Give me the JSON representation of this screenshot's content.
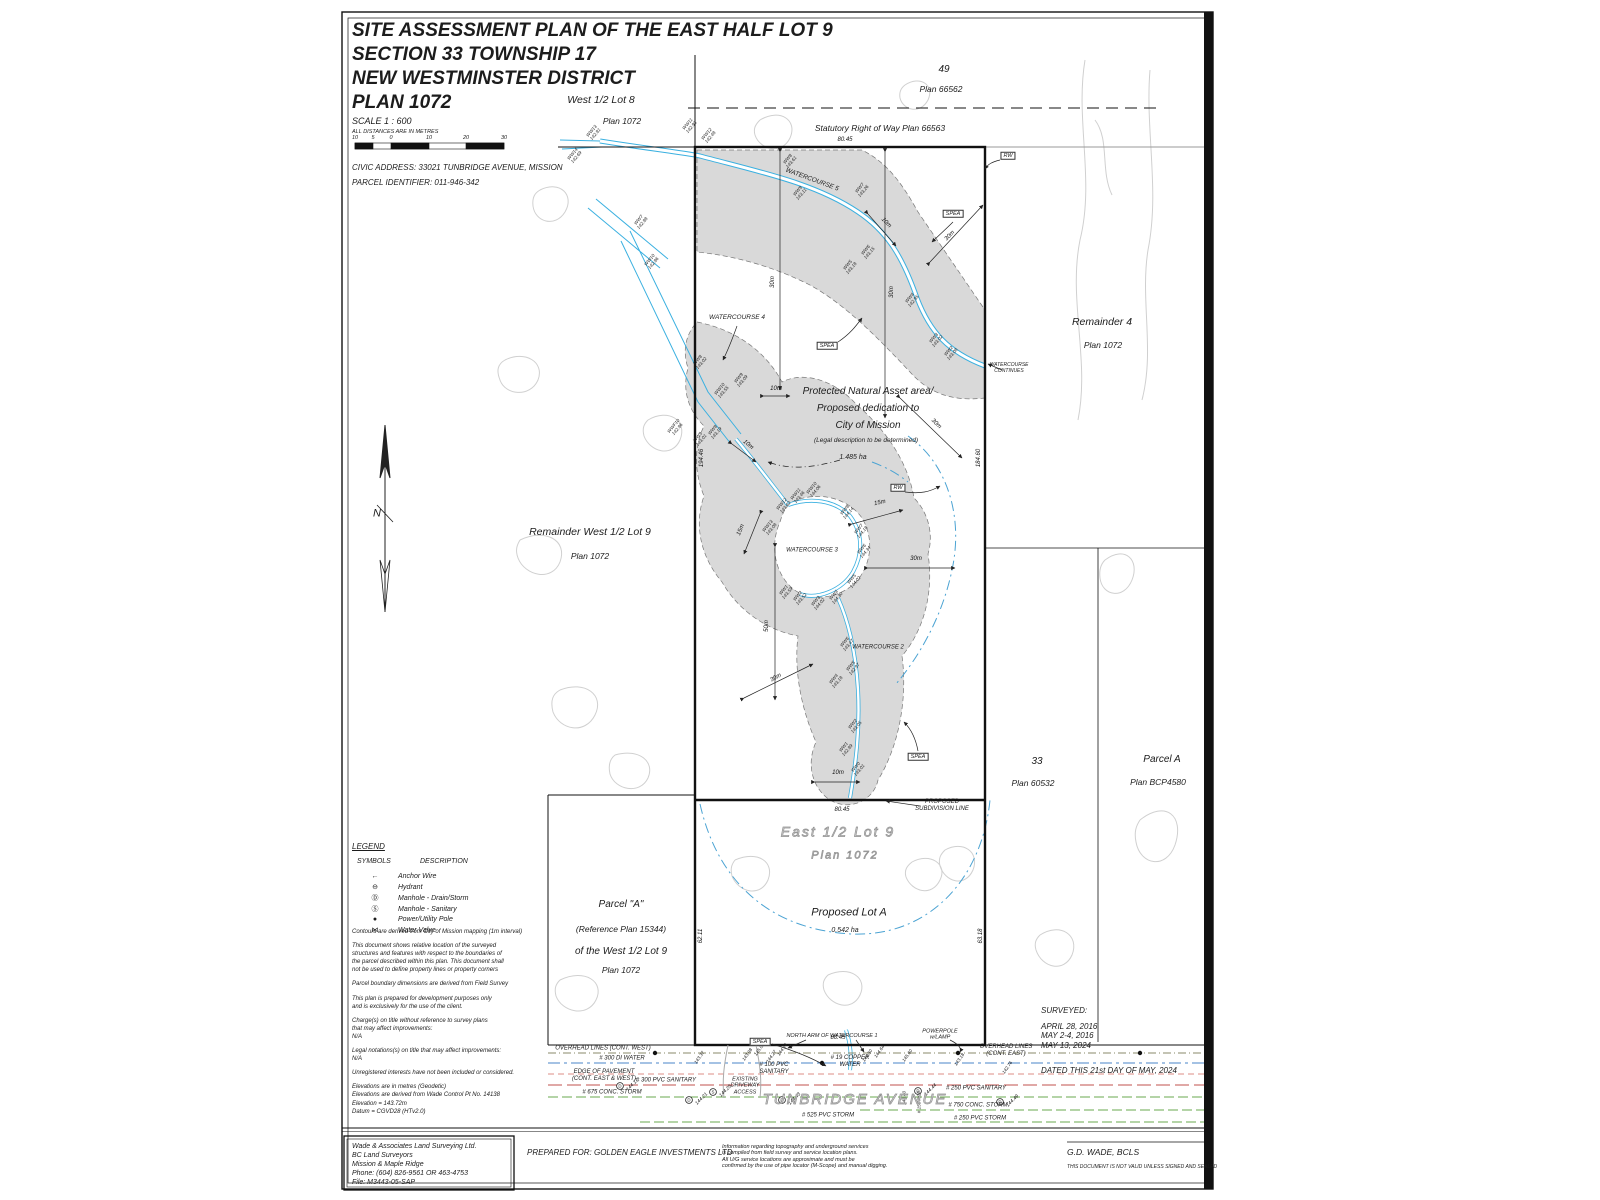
{
  "title_block": {
    "line1": "SITE ASSESSMENT PLAN OF THE EAST HALF LOT 9",
    "line2": "SECTION 33 TOWNSHIP 17",
    "line3": "NEW WESTMINSTER DISTRICT",
    "line4": "PLAN 1072",
    "scale_label": "SCALE    1 : 600",
    "distance_note": "ALL DISTANCES ARE IN METRES",
    "scale_ticks": [
      "10",
      "5",
      "0",
      "10",
      "20",
      "30"
    ],
    "civic_address": "CIVIC ADDRESS: 33021 TUNBRIDGE AVENUE, MISSION",
    "parcel_id": "PARCEL IDENTIFIER: 011-946-342"
  },
  "legend": {
    "heading": "LEGEND",
    "symbols_header": "SYMBOLS",
    "description_header": "DESCRIPTION",
    "items": [
      {
        "sym": "←",
        "label": "Anchor Wire"
      },
      {
        "sym": "⊖",
        "label": "Hydrant"
      },
      {
        "sym": "Ⓓ",
        "label": "Manhole - Drain/Storm"
      },
      {
        "sym": "Ⓢ",
        "label": "Manhole - Sanitary"
      },
      {
        "sym": "●",
        "label": "Power/Utility Pole"
      },
      {
        "sym": "⋈",
        "label": "Water Valve"
      }
    ]
  },
  "notes": [
    "Contours are derived from City of Mission mapping (1m interval)",
    "This document shows relative location of the surveyed\nstructures and features with respect to the boundaries of\nthe parcel described within this plan. This document shall\nnot be used to define property lines or property corners",
    "Parcel boundary dimensions are derived from Field Survey",
    "This plan is prepared for development purposes only\nand is exclusively for the use of the client.",
    "Charge(s) on title without reference to survey plans\nthat may affect improvements:\nN/A",
    "Legal notations(s) on title that may affect improvements:\nN/A",
    "Unregistered interests have not been included or considered.",
    "Elevations are in metres (Geodetic)\nElevations are derived from Wade Control Pt No. 14138\nElevation = 143.72m\nDatum = CGVD28 (HTv2.0)"
  ],
  "firm_box": {
    "lines": [
      "Wade & Associates Land Surveying Ltd.",
      "BC Land Surveyors",
      "Mission & Maple Ridge",
      "Phone: (604) 826-9561 OR 463-4753",
      "File: M3443-05-SAP"
    ]
  },
  "footer": {
    "prepared_for": "PREPARED FOR: GOLDEN EAGLE INVESTMENTS LTD",
    "info_note": "Information regarding topography and underground services\nis compiled from field survey and service location plans.\nAll U/G service locations are approximate and must be\nconfirmed by the use of pipe locator (M-Scope) and manual digging.",
    "surveyed_heading": "SURVEYED:",
    "survey_dates": [
      "APRIL 28, 2016",
      "MAY 2-4, 2016",
      "MAY 13, 2024"
    ],
    "dated_line": "DATED THIS 21st DAY OF MAY, 2024",
    "surveyor": "G.D. WADE, BCLS",
    "validity_note": "THIS DOCUMENT IS NOT VALID UNLESS SIGNED AND SEALED"
  },
  "plan": {
    "parcels": {
      "west_lot8": {
        "name": "West 1/2 Lot 8",
        "plan": "Plan 1072"
      },
      "lot49": {
        "name": "49",
        "plan": "Plan 66562"
      },
      "row": "Statutory Right of Way Plan 66563",
      "remainder4": {
        "name": "Remainder 4",
        "plan": "Plan 1072"
      },
      "remainder_w9": {
        "name": "Remainder West 1/2 Lot 9",
        "plan": "Plan 1072"
      },
      "east9": {
        "name": "East 1/2 Lot 9",
        "plan": "Plan 1072"
      },
      "proposed_lot_a": {
        "name": "Proposed Lot A",
        "area": "0.542 ha"
      },
      "parcel_a_ref": {
        "l1": "Parcel \"A\"",
        "l2": "(Reference Plan 15344)",
        "l3": "of the West 1/2 Lot 9",
        "l4": "Plan 1072"
      },
      "lot33": {
        "name": "33",
        "plan": "Plan 60532"
      },
      "parcel_a_bcp": {
        "name": "Parcel A",
        "plan": "Plan BCP4580"
      }
    },
    "pna": {
      "l1": "Protected Natural Asset area/",
      "l2": "Proposed dedication to",
      "l3": "City of Mission",
      "l4": "(Legal description to be determined)",
      "l5": "1.485 ha"
    },
    "subdivision_label": "PROPOSED\nSUBDIVISION LINE",
    "watercourses": {
      "wc5": "WATERCOURSE 5",
      "wc4": "WATERCOURSE 4",
      "wc3": "WATERCOURSE 3",
      "wc2": "WATERCOURSE 2",
      "continues": "WATERCOURSE\nCONTINUES",
      "north_arm": "NORTH ARM OF WATERCOURSE 1"
    },
    "boxes": {
      "rw": "RW",
      "spea": "SPEA"
    },
    "street": "TUNBRIDGE AVENUE",
    "north_symbol": "N",
    "road_labels": {
      "overhead_west": "OVERHEAD LINES (CONT. WEST)",
      "overhead_east": "OVERHEAD LINES\n(CONT. EAST)",
      "water300": "# 300 DI WATER",
      "pavement": "EDGE OF PAVEMENT\n(CONT. EAST & WEST)",
      "san300": "# 300 PVC SANITARY",
      "storm675": "# 675 CONC. STORM",
      "san100": "# 100 PVC\nSANITARY",
      "copper19": "# 19 COPPER\nWATER",
      "powerpole": "POWERPOLE\nw/LAMP",
      "driveway": "EXISTING\nDRIVEWAY\nACCESS",
      "san250": "# 250 PVC SANITARY",
      "storm750": "# 750 CONC. STORM",
      "storm250": "# 250 PVC STORM",
      "storm525": "# 525 PVC STORM"
    },
    "dim_labels": [
      {
        "t": "80.45",
        "x": 845,
        "y": 140,
        "r": 0
      },
      {
        "t": "80.45",
        "x": 842,
        "y": 810,
        "r": 0
      },
      {
        "t": "80.45",
        "x": 838,
        "y": 1038,
        "r": 0
      },
      {
        "t": "30m",
        "x": 773,
        "y": 282,
        "r": -90
      },
      {
        "t": "30m",
        "x": 892,
        "y": 292,
        "r": -90
      },
      {
        "t": "30m",
        "x": 950,
        "y": 236,
        "r": -46
      },
      {
        "t": "30m",
        "x": 936,
        "y": 424,
        "r": 44
      },
      {
        "t": "30m",
        "x": 916,
        "y": 559,
        "r": 0
      },
      {
        "t": "30m",
        "x": 776,
        "y": 678,
        "r": -29
      },
      {
        "t": "50m",
        "x": 767,
        "y": 626,
        "r": -90
      },
      {
        "t": "15m",
        "x": 880,
        "y": 503,
        "r": -12
      },
      {
        "t": "15m",
        "x": 741,
        "y": 530,
        "r": -68
      },
      {
        "t": "10m",
        "x": 776,
        "y": 389,
        "r": 0
      },
      {
        "t": "10m",
        "x": 748,
        "y": 445,
        "r": 40
      },
      {
        "t": "10m",
        "x": 886,
        "y": 223,
        "r": 46
      },
      {
        "t": "10m",
        "x": 838,
        "y": 773,
        "r": 0
      },
      {
        "t": "194.46",
        "x": 702,
        "y": 458,
        "r": -90
      },
      {
        "t": "184.60",
        "x": 979,
        "y": 458,
        "r": -90
      },
      {
        "t": "62.11",
        "x": 701,
        "y": 936,
        "r": -90
      },
      {
        "t": "63.18",
        "x": 981,
        "y": 936,
        "r": -90
      }
    ],
    "spot_labels": [
      {
        "t": "WW13\n142.81",
        "x": 594,
        "y": 133,
        "r": -50
      },
      {
        "t": "WW14\n142.69",
        "x": 575,
        "y": 156,
        "r": -50
      },
      {
        "t": "WW11\n142.93",
        "x": 690,
        "y": 126,
        "r": -50
      },
      {
        "t": "WW12\n142.48",
        "x": 709,
        "y": 136,
        "r": -50
      },
      {
        "t": "WW8\n143.61",
        "x": 790,
        "y": 161,
        "r": -50
      },
      {
        "t": "WW7\n143.26",
        "x": 862,
        "y": 190,
        "r": -50
      },
      {
        "t": "WW9\n143.11",
        "x": 800,
        "y": 193,
        "r": -50
      },
      {
        "t": "WW6\n143.15",
        "x": 868,
        "y": 252,
        "r": -50
      },
      {
        "t": "WW5\n143.18",
        "x": 850,
        "y": 267,
        "r": -50
      },
      {
        "t": "WW4\n142.95",
        "x": 912,
        "y": 300,
        "r": -50
      },
      {
        "t": "WW3\n143.02",
        "x": 936,
        "y": 340,
        "r": -50
      },
      {
        "t": "WW2\n143.08",
        "x": 951,
        "y": 353,
        "r": -50
      },
      {
        "t": "WW7\n142.88",
        "x": 641,
        "y": 222,
        "r": -50
      },
      {
        "t": "WW10\n142.86",
        "x": 652,
        "y": 262,
        "r": -50
      },
      {
        "t": "WW8\n143.02",
        "x": 700,
        "y": 362,
        "r": -50
      },
      {
        "t": "WW10\n143.55",
        "x": 722,
        "y": 391,
        "r": -50
      },
      {
        "t": "WW9\n143.09",
        "x": 741,
        "y": 380,
        "r": -50
      },
      {
        "t": "WWF10\n142.86",
        "x": 676,
        "y": 428,
        "r": -50
      },
      {
        "t": "WW9\n143.01",
        "x": 700,
        "y": 439,
        "r": -50
      },
      {
        "t": "WW8\n143.19",
        "x": 715,
        "y": 432,
        "r": -50
      },
      {
        "t": "WW13\n143.08",
        "x": 770,
        "y": 528,
        "r": -50
      },
      {
        "t": "WW12\n143.62",
        "x": 784,
        "y": 506,
        "r": -50
      },
      {
        "t": "WW11\n143.46",
        "x": 798,
        "y": 496,
        "r": -50
      },
      {
        "t": "WW10\n144.06",
        "x": 814,
        "y": 490,
        "r": -50
      },
      {
        "t": "WW8\n144.14",
        "x": 847,
        "y": 512,
        "r": -50
      },
      {
        "t": "WW7\n144.18",
        "x": 861,
        "y": 531,
        "r": -50
      },
      {
        "t": "WW6\n144.34",
        "x": 864,
        "y": 551,
        "r": -50
      },
      {
        "t": "WW5\n144.02",
        "x": 854,
        "y": 581,
        "r": -50
      },
      {
        "t": "WW4\n144.30",
        "x": 836,
        "y": 597,
        "r": -50
      },
      {
        "t": "WW3\n144.02",
        "x": 818,
        "y": 603,
        "r": -50
      },
      {
        "t": "WW2\n143.52",
        "x": 800,
        "y": 598,
        "r": -50
      },
      {
        "t": "WW1\n143.59",
        "x": 786,
        "y": 592,
        "r": -50
      },
      {
        "t": "WW6\n143.47",
        "x": 847,
        "y": 644,
        "r": -50
      },
      {
        "t": "WW5\n142.97",
        "x": 853,
        "y": 668,
        "r": -50
      },
      {
        "t": "WW4\n143.18",
        "x": 836,
        "y": 681,
        "r": -50
      },
      {
        "t": "WW2\n143.05",
        "x": 855,
        "y": 726,
        "r": -50
      },
      {
        "t": "WW1\n142.89",
        "x": 846,
        "y": 749,
        "r": -50
      },
      {
        "t": "WW0\n143.01",
        "x": 858,
        "y": 769,
        "r": -50
      },
      {
        "t": "143.37",
        "x": 700,
        "y": 1058,
        "r": -55
      },
      {
        "t": "143.98",
        "x": 748,
        "y": 1055,
        "r": -55
      },
      {
        "t": "145.08",
        "x": 760,
        "y": 1050,
        "r": -55
      },
      {
        "t": "144.27",
        "x": 772,
        "y": 1057,
        "r": -55
      },
      {
        "t": "144.14",
        "x": 783,
        "y": 1050,
        "r": -55
      },
      {
        "t": "144.50",
        "x": 868,
        "y": 1056,
        "r": -55
      },
      {
        "t": "144.64",
        "x": 880,
        "y": 1052,
        "r": -55
      },
      {
        "t": "145.60",
        "x": 908,
        "y": 1056,
        "r": -55
      },
      {
        "t": "143.18",
        "x": 960,
        "y": 1060,
        "r": -55
      },
      {
        "t": "142.76",
        "x": 1008,
        "y": 1068,
        "r": -55
      },
      {
        "t": "# 150 RCP",
        "x": 920,
        "y": 1102,
        "r": -90
      },
      {
        "t": "144.40",
        "x": 905,
        "y": 1098,
        "r": -90
      }
    ],
    "manholes": [
      {
        "x": 620,
        "y": 1086,
        "l": "D",
        "v": "144.17"
      },
      {
        "x": 689,
        "y": 1100,
        "l": "D",
        "v": "144.21"
      },
      {
        "x": 713,
        "y": 1092,
        "l": "S",
        "v": "144.25"
      },
      {
        "x": 782,
        "y": 1100,
        "l": "D",
        "v": "144.43"
      },
      {
        "x": 918,
        "y": 1091,
        "l": "D",
        "v": "144.44"
      },
      {
        "x": 1000,
        "y": 1102,
        "l": "D",
        "v": "144.49"
      }
    ],
    "poles": [
      {
        "x": 655,
        "y": 1053
      },
      {
        "x": 958,
        "y": 1053
      },
      {
        "x": 1140,
        "y": 1053
      },
      {
        "x": 822,
        "y": 1063
      }
    ],
    "contours": [
      "M540,190 C560,180 575,195 565,212 C555,228 535,222 533,206 C532,197 535,193 540,190",
      "M505,360 C525,350 545,362 538,380 C530,398 505,395 500,380 C496,370 498,364 505,360",
      "M560,690 C585,680 605,695 595,715 C585,735 560,730 553,712 C550,700 553,694 560,690",
      "M615,755 C640,748 655,762 648,778 C640,795 615,790 610,774 C608,765 610,759 615,755",
      "M1085,60 C1075,120 1095,180 1080,240 C1068,300 1090,360 1078,420",
      "M1150,70 C1145,130 1160,190 1148,250 C1140,300 1155,350 1142,400",
      "M1105,560 C1125,545 1140,560 1132,580 C1124,600 1102,596 1100,578 C1099,570 1101,564 1105,560",
      "M1140,820 C1165,800 1185,815 1175,845 C1166,870 1140,865 1136,842 C1134,832 1136,826 1140,820",
      "M760,120 C780,108 798,120 790,138 C782,155 760,150 755,135 C753,128 756,124 760,120",
      "M905,85 C920,75 935,85 928,100 C920,115 903,110 900,98 C899,92 901,88 905,85",
      "M560,980 C585,968 605,982 596,1000 C587,1018 562,1012 556,996 C554,988 556,984 560,980",
      "M1040,935 C1060,922 1080,935 1072,955 C1064,973 1042,968 1036,950 C1034,943 1036,939 1040,935",
      "M828,975 C850,965 868,978 860,995 C852,1012 830,1006 824,990 C822,983 824,979 828,975",
      "M912,862 C930,852 948,864 940,880 C932,897 912,892 906,877 C904,870 907,866 912,862",
      "M648,420 C668,408 688,420 680,440 C672,458 650,452 644,436 C642,428 644,424 648,420",
      "M520,540 C545,528 568,540 560,562 C552,582 525,576 518,558 C515,550 517,545 520,540",
      "M735,860 C758,850 775,862 768,880 C760,898 738,892 732,876 C730,868 732,864 735,860",
      "M945,850 C963,840 980,852 973,870 C965,888 945,882 940,866 C938,858 941,854 945,850",
      "M1095,120 C1110,140 1100,170 1112,195"
    ]
  },
  "colors": {
    "watercourse": "#3ab0e0",
    "spea_fill": "#d9d9d9",
    "water_util": "#4a86c8",
    "sanitary": "#c0504d",
    "storm": "#6aa84f",
    "pavement_edge": "#d26a5c",
    "overhead": "#8a8a6a"
  }
}
